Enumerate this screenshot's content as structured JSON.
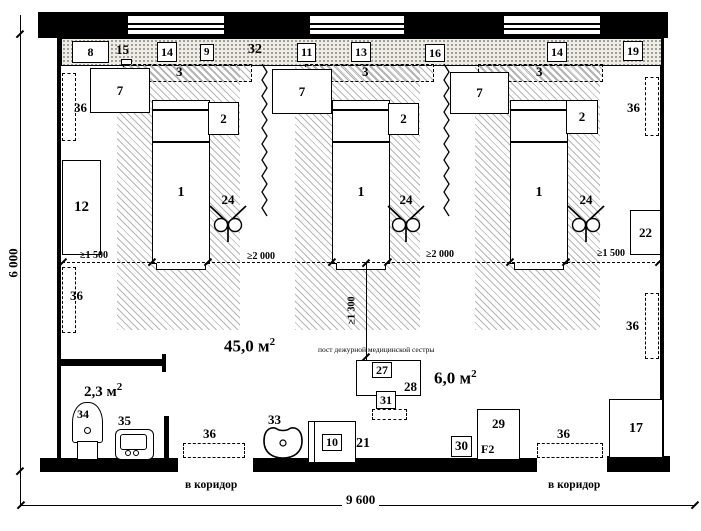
{
  "dims": {
    "height_total": "6 000",
    "width_total": "9 600",
    "clear_left": "≥1 500",
    "clear_mid1": "≥2 000",
    "clear_mid2": "≥2 000",
    "clear_right": "≥1 500",
    "clear_vertical": "≥1 300"
  },
  "areas": {
    "ward_value": "45,0 м",
    "post_value": "6,0 м",
    "sanitary_value": "2,3 м",
    "sup": "2"
  },
  "band": {
    "items": [
      "8",
      "15",
      "14",
      "9",
      "32",
      "11",
      "13",
      "16",
      "14",
      "19"
    ]
  },
  "zones": {
    "bed_label": "1",
    "table_label": "2",
    "frame_label": "3",
    "cabinet_label": "7",
    "lamp_label": "24"
  },
  "left_side": {
    "radiator_top": "36",
    "wardrobe": "12",
    "radiator_bottom": "36"
  },
  "right_side": {
    "radiator_top": "36",
    "cabinet": "22",
    "radiator_bottom": "36"
  },
  "nurse_post": {
    "caption": "пост дежурной медицинской сестры",
    "item_27": "27",
    "desk_28": "28",
    "chair_31": "31"
  },
  "sanitary": {
    "toilet_34": "34",
    "basin_35": "35"
  },
  "bottom_items": {
    "mat_left_36": "36",
    "sink_33": "33",
    "cabinet_10": "10",
    "label_21": "21",
    "item_30": "30",
    "fridge_29": "29",
    "fridge_mark": "F2",
    "mat_right_36": "36",
    "wardrobe_17": "17"
  },
  "corridor": {
    "left": "в коридор",
    "right": "в коридор"
  }
}
